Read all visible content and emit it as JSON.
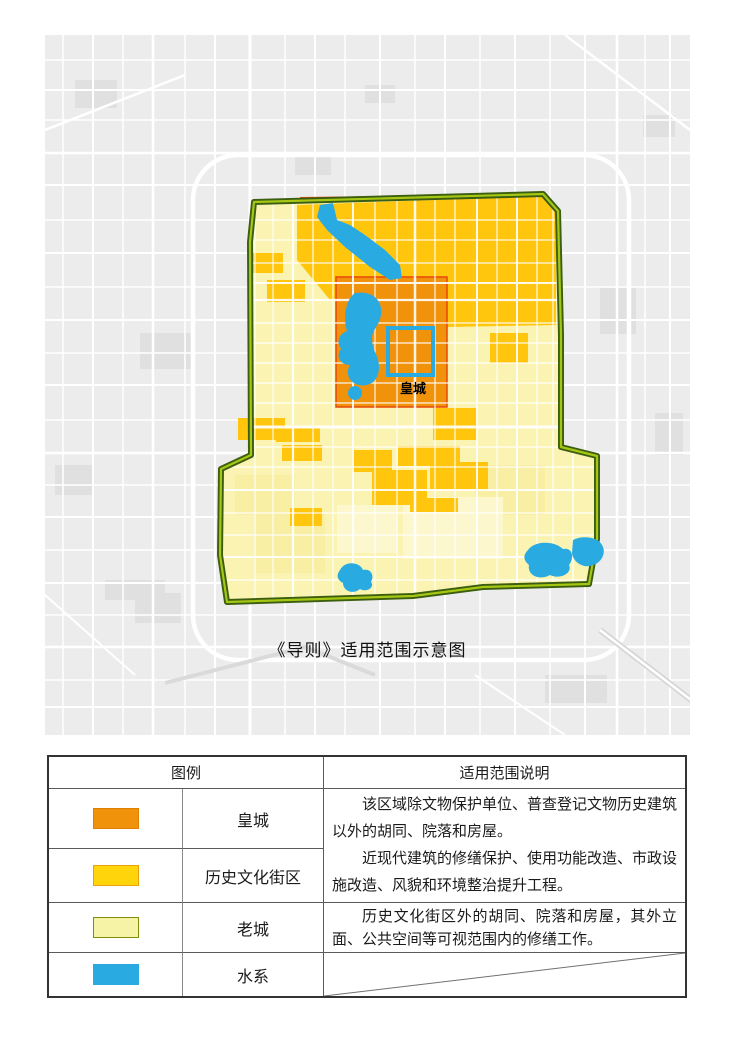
{
  "figure": {
    "caption": "《导则》适用范围示意图",
    "map_label_imperial_city": "皇城",
    "colors": {
      "basemap_gray": "#ECECEC",
      "basemap_patch_gray": "#E0E0E0",
      "road_white": "#FFFFFF",
      "old_city_fill": "#FBF3B2",
      "historic_district_gold": "#FFC60D",
      "imperial_city_orange": "#F0920A",
      "water_blue": "#29ABE2",
      "boundary_dark_green": "#3C5E10",
      "boundary_light_green": "#A6C614",
      "imperial_outline_red": "#E8470B"
    }
  },
  "legend_table": {
    "header": {
      "legend": "图例",
      "description": "适用范围说明"
    },
    "rows": [
      {
        "label": "皇城",
        "swatch_color": "#F0920A",
        "swatch_border": "#DE7F00"
      },
      {
        "label": "历史文化街区",
        "swatch_color": "#FFD40A",
        "swatch_border": "#E8A30A"
      },
      {
        "label": "老城",
        "swatch_color": "#F6F2A6",
        "swatch_border": "#7F8F0A"
      },
      {
        "label": "水系",
        "swatch_color": "#29ABE2",
        "swatch_border": "#29ABE2"
      }
    ],
    "descriptions": {
      "imperial_and_districts_p1": "该区域除文物保护单位、普查登记文物历史建筑以外的胡同、院落和房屋。",
      "imperial_and_districts_p2": "近现代建筑的修缮保护、使用功能改造、市政设施改造、风貌和环境整治提升工程。",
      "old_city": "历史文化街区外的胡同、院落和房屋，其外立面、公共空间等可视范围内的修缮工作。",
      "water": ""
    }
  }
}
